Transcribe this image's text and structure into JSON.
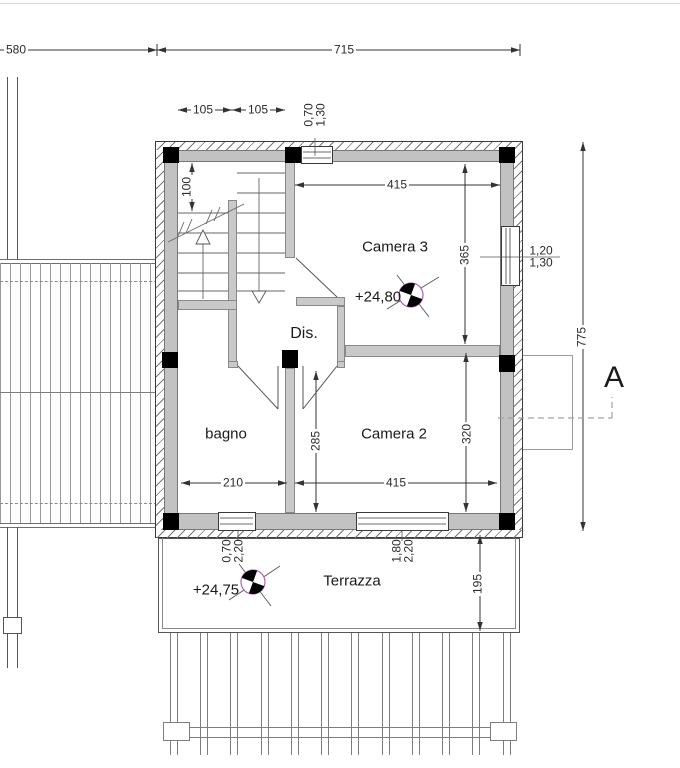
{
  "watermark": {
    "text": "trovacasa"
  },
  "section_marker": {
    "label": "A"
  },
  "rooms": {
    "camera3": {
      "name": "Camera 3",
      "level": "+24,80"
    },
    "camera2": {
      "name": "Camera 2"
    },
    "bagno": {
      "name": "bagno"
    },
    "dis": {
      "name": "Dis."
    },
    "terrazza": {
      "name": "Terrazza",
      "level": "+24,75"
    }
  },
  "dimensions": {
    "left_overall": "580",
    "plan_width": "715",
    "stair_bay_left": "105",
    "stair_bay_right": "105",
    "landing_depth": "100",
    "camera3_width": "415",
    "camera3_depth": "365",
    "camera2_width": "415",
    "camera2_depth": "320",
    "bagno_width": "210",
    "dis_depth": "285",
    "plan_height": "775",
    "terrace_depth": "195"
  },
  "openings": {
    "top_window": {
      "width": "0,70",
      "height": "1,30"
    },
    "right_window": {
      "width": "1,20",
      "height": "1,30"
    },
    "bagno_door": {
      "width": "0,70",
      "height": "2,20"
    },
    "terrace_door": {
      "width": "1,80",
      "height": "2,20"
    }
  },
  "colors": {
    "wall": "#c2c2c2",
    "partition": "#c9c9c9",
    "column": "#000000",
    "level_marker": "#b05fb0",
    "watermark": "#e0e0e0"
  }
}
